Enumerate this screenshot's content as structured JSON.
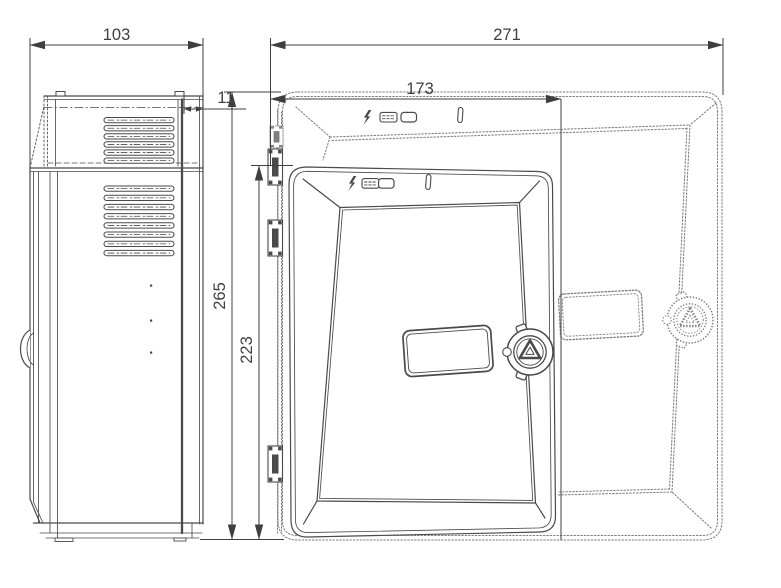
{
  "drawing": {
    "type": "technical-dimension-drawing",
    "subject": "wall-mounted enclosure with hinged door, side view and front view",
    "dimensions": {
      "side_depth": "103",
      "lid_depth": "11",
      "front_width": "271",
      "door_width": "173",
      "front_height": "265",
      "door_height": "223"
    },
    "icons": [
      {
        "name": "mains-power-icon",
        "glyph": "lightning-bolt"
      },
      {
        "name": "battery-charge-icon",
        "glyph": "striped-cell"
      },
      {
        "name": "battery-icon",
        "glyph": "empty-cell"
      },
      {
        "name": "key-slot-icon",
        "glyph": "vertical-slot"
      }
    ],
    "colors": {
      "background": "#ffffff",
      "solid_line": "#4a4a4a",
      "hidden_line": "#7e7e7e",
      "dimension": "#3f3f3f"
    }
  }
}
